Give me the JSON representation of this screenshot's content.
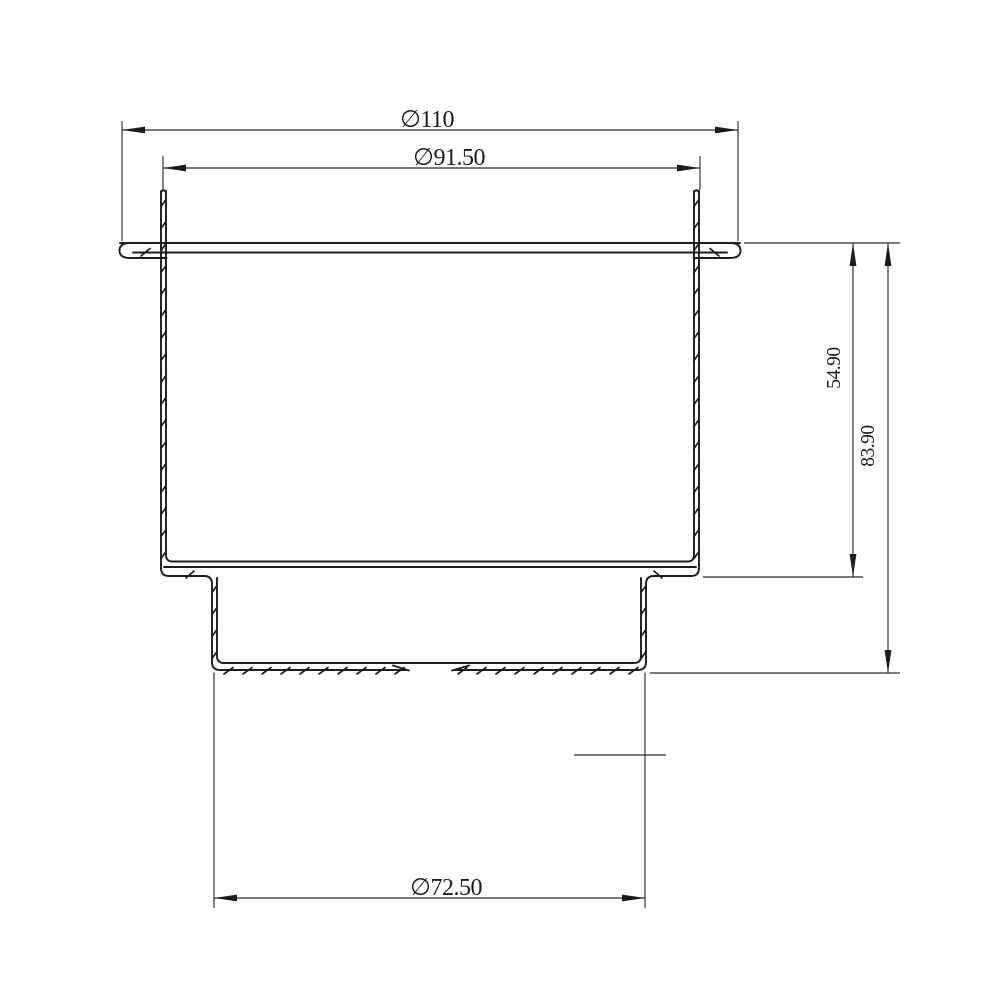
{
  "colors": {
    "background": "#ffffff",
    "line": "#1c1c1c",
    "dimension_line": "#2b2b2b"
  },
  "dimensions": {
    "outer_flange_diameter": {
      "label": "∅110"
    },
    "body_diameter": {
      "label": "∅91.50"
    },
    "upper_depth": {
      "label": "54.90"
    },
    "total_depth": {
      "label": "83.90"
    },
    "base_diameter": {
      "label": "∅72.50"
    }
  }
}
